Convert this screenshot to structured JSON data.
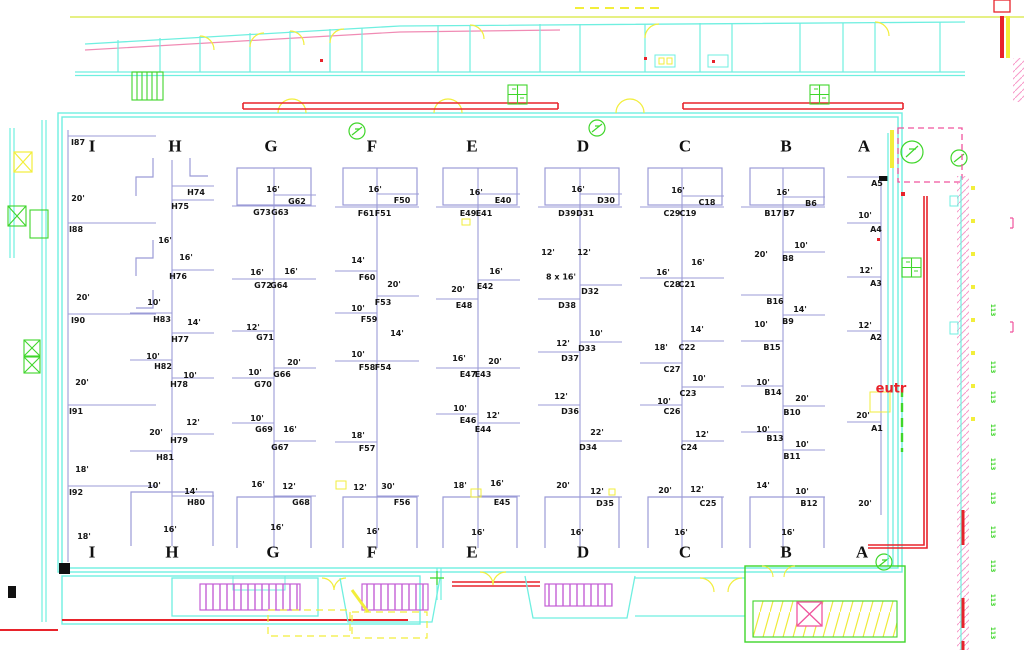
{
  "title": "Exhibit hall booth layout floor plan",
  "colors": {
    "wall_cyan": "#6fefe0",
    "booth_line": "#9b9bd7",
    "accent_red": "#e8232b",
    "yellow": "#f2ee3b",
    "green": "#3fd62a",
    "purple_hatch": "#c45fd6",
    "pink_hatch": "#f799c9",
    "magenta_dash": "#f0559e",
    "pink_line": "#f08bb4",
    "text": "#151515"
  },
  "letters": {
    "y_top": 146,
    "y_bottom": 552,
    "top": [
      {
        "t": "I",
        "x": 92
      },
      {
        "t": "H",
        "x": 175
      },
      {
        "t": "G",
        "x": 271
      },
      {
        "t": "F",
        "x": 372
      },
      {
        "t": "E",
        "x": 472
      },
      {
        "t": "D",
        "x": 583
      },
      {
        "t": "C",
        "x": 685
      },
      {
        "t": "B",
        "x": 786
      },
      {
        "t": "A",
        "x": 864
      }
    ],
    "bottom": [
      {
        "t": "I",
        "x": 92
      },
      {
        "t": "H",
        "x": 172
      },
      {
        "t": "G",
        "x": 273
      },
      {
        "t": "F",
        "x": 372
      },
      {
        "t": "E",
        "x": 472
      },
      {
        "t": "D",
        "x": 583
      },
      {
        "t": "C",
        "x": 685
      },
      {
        "t": "B",
        "x": 786
      },
      {
        "t": "A",
        "x": 862
      }
    ]
  },
  "spines": {
    "I": {
      "x": 68,
      "y1": 130,
      "y2": 562,
      "tlen": 88
    },
    "H": {
      "x": 172,
      "y1": 160,
      "y2": 546,
      "tlen": 42
    },
    "G": {
      "x": 274,
      "y1": 168,
      "y2": 548,
      "tlen": 42
    },
    "F": {
      "x": 377,
      "y1": 168,
      "y2": 548,
      "tlen": 42
    },
    "E": {
      "x": 478,
      "y1": 168,
      "y2": 548,
      "tlen": 42
    },
    "D": {
      "x": 580,
      "y1": 168,
      "y2": 548,
      "tlen": 42
    },
    "C": {
      "x": 682,
      "y1": 168,
      "y2": 548,
      "tlen": 42
    },
    "B": {
      "x": 783,
      "y1": 168,
      "y2": 548,
      "tlen": 42
    },
    "A": {
      "x": 881,
      "y1": 178,
      "y2": 515,
      "tlen": 34
    }
  },
  "booths": [
    [
      "I87",
      78,
      143
    ],
    [
      "I88",
      76,
      230
    ],
    [
      "I90",
      78,
      321
    ],
    [
      "I91",
      76,
      412
    ],
    [
      "I92",
      76,
      493
    ],
    [
      "H74",
      196,
      193
    ],
    [
      "H75",
      180,
      207
    ],
    [
      "H76",
      178,
      277
    ],
    [
      "H83",
      162,
      320
    ],
    [
      "H77",
      180,
      340
    ],
    [
      "H82",
      163,
      367
    ],
    [
      "H78",
      179,
      385
    ],
    [
      "H79",
      179,
      441
    ],
    [
      "H81",
      165,
      458
    ],
    [
      "H80",
      196,
      503
    ],
    [
      "G62",
      297,
      202
    ],
    [
      "G73",
      262,
      213
    ],
    [
      "G63",
      280,
      213
    ],
    [
      "G72",
      263,
      286
    ],
    [
      "G64",
      279,
      286
    ],
    [
      "G71",
      265,
      338
    ],
    [
      "G66",
      282,
      375
    ],
    [
      "G70",
      263,
      385
    ],
    [
      "G69",
      264,
      430
    ],
    [
      "G67",
      280,
      448
    ],
    [
      "G68",
      301,
      503
    ],
    [
      "F50",
      402,
      201
    ],
    [
      "F61",
      366,
      214
    ],
    [
      "F51",
      383,
      214
    ],
    [
      "F60",
      367,
      278
    ],
    [
      "F53",
      383,
      303
    ],
    [
      "F59",
      369,
      320
    ],
    [
      "F58",
      367,
      368
    ],
    [
      "F54",
      383,
      368
    ],
    [
      "F57",
      367,
      449
    ],
    [
      "F56",
      402,
      503
    ],
    [
      "E40",
      503,
      201
    ],
    [
      "E49",
      468,
      214
    ],
    [
      "E41",
      484,
      214
    ],
    [
      "E42",
      485,
      287
    ],
    [
      "E48",
      464,
      306
    ],
    [
      "E47",
      468,
      375
    ],
    [
      "E43",
      483,
      375
    ],
    [
      "E46",
      468,
      421
    ],
    [
      "E44",
      483,
      430
    ],
    [
      "E45",
      502,
      503
    ],
    [
      "D30",
      606,
      201
    ],
    [
      "D39",
      567,
      214
    ],
    [
      "D31",
      585,
      214
    ],
    [
      "D32",
      590,
      292
    ],
    [
      "D38",
      567,
      306
    ],
    [
      "D33",
      587,
      349
    ],
    [
      "D37",
      570,
      359
    ],
    [
      "D36",
      570,
      412
    ],
    [
      "D34",
      588,
      448
    ],
    [
      "D35",
      605,
      504
    ],
    [
      "C18",
      707,
      203
    ],
    [
      "C29",
      672,
      214
    ],
    [
      "C19",
      688,
      214
    ],
    [
      "C28",
      672,
      285
    ],
    [
      "C21",
      687,
      285
    ],
    [
      "C22",
      687,
      348
    ],
    [
      "C27",
      672,
      370
    ],
    [
      "C23",
      688,
      394
    ],
    [
      "C26",
      672,
      412
    ],
    [
      "C24",
      689,
      448
    ],
    [
      "C25",
      708,
      504
    ],
    [
      "B6",
      811,
      204
    ],
    [
      "B17",
      773,
      214
    ],
    [
      "B7",
      789,
      214
    ],
    [
      "B8",
      788,
      259
    ],
    [
      "B16",
      775,
      302
    ],
    [
      "B9",
      788,
      322
    ],
    [
      "B15",
      772,
      348
    ],
    [
      "B14",
      773,
      393
    ],
    [
      "B10",
      792,
      413
    ],
    [
      "B13",
      775,
      439
    ],
    [
      "B11",
      792,
      457
    ],
    [
      "B12",
      809,
      504
    ],
    [
      "A5",
      877,
      184
    ],
    [
      "A4",
      876,
      230
    ],
    [
      "A3",
      876,
      284
    ],
    [
      "A2",
      876,
      338
    ],
    [
      "A1",
      877,
      429
    ]
  ],
  "dims": [
    [
      "20'",
      78,
      199
    ],
    [
      "20'",
      83,
      298
    ],
    [
      "20'",
      82,
      383
    ],
    [
      "18'",
      82,
      470
    ],
    [
      "18'",
      84,
      537
    ],
    [
      "16'",
      165,
      241
    ],
    [
      "16'",
      186,
      258
    ],
    [
      "10'",
      154,
      303
    ],
    [
      "14'",
      194,
      323
    ],
    [
      "10'",
      153,
      357
    ],
    [
      "10'",
      190,
      376
    ],
    [
      "12'",
      193,
      423
    ],
    [
      "20'",
      156,
      433
    ],
    [
      "10'",
      154,
      486
    ],
    [
      "14'",
      191,
      492
    ],
    [
      "16'",
      170,
      530
    ],
    [
      "16'",
      273,
      190
    ],
    [
      "16'",
      257,
      273
    ],
    [
      "16'",
      291,
      272
    ],
    [
      "12'",
      253,
      328
    ],
    [
      "20'",
      294,
      363
    ],
    [
      "10'",
      255,
      373
    ],
    [
      "10'",
      257,
      419
    ],
    [
      "16'",
      290,
      430
    ],
    [
      "16'",
      258,
      485
    ],
    [
      "12'",
      289,
      487
    ],
    [
      "16'",
      277,
      528
    ],
    [
      "16'",
      375,
      190
    ],
    [
      "14'",
      358,
      261
    ],
    [
      "20'",
      394,
      285
    ],
    [
      "10'",
      358,
      309
    ],
    [
      "14'",
      397,
      334
    ],
    [
      "10'",
      358,
      355
    ],
    [
      "18'",
      358,
      436
    ],
    [
      "12'",
      360,
      488
    ],
    [
      "30'",
      388,
      487
    ],
    [
      "16'",
      373,
      532
    ],
    [
      "16'",
      476,
      193
    ],
    [
      "16'",
      496,
      272
    ],
    [
      "20'",
      458,
      290
    ],
    [
      "16'",
      459,
      359
    ],
    [
      "20'",
      495,
      362
    ],
    [
      "10'",
      460,
      409
    ],
    [
      "12'",
      493,
      416
    ],
    [
      "18'",
      460,
      486
    ],
    [
      "16'",
      497,
      484
    ],
    [
      "16'",
      478,
      533
    ],
    [
      "16'",
      578,
      190
    ],
    [
      "12'",
      548,
      253
    ],
    [
      "12'",
      584,
      253
    ],
    [
      "10'",
      596,
      334
    ],
    [
      "12'",
      563,
      344
    ],
    [
      "12'",
      561,
      397
    ],
    [
      "22'",
      597,
      433
    ],
    [
      "20'",
      563,
      486
    ],
    [
      "12'",
      597,
      492
    ],
    [
      "16'",
      577,
      533
    ],
    [
      "16'",
      678,
      191
    ],
    [
      "16'",
      698,
      263
    ],
    [
      "16'",
      663,
      273
    ],
    [
      "14'",
      697,
      330
    ],
    [
      "18'",
      661,
      348
    ],
    [
      "10'",
      699,
      379
    ],
    [
      "10'",
      664,
      402
    ],
    [
      "12'",
      702,
      435
    ],
    [
      "20'",
      665,
      491
    ],
    [
      "12'",
      697,
      490
    ],
    [
      "16'",
      681,
      533
    ],
    [
      "16'",
      783,
      193
    ],
    [
      "10'",
      801,
      246
    ],
    [
      "20'",
      761,
      255
    ],
    [
      "14'",
      800,
      310
    ],
    [
      "10'",
      761,
      325
    ],
    [
      "10'",
      763,
      383
    ],
    [
      "20'",
      802,
      399
    ],
    [
      "10'",
      763,
      430
    ],
    [
      "10'",
      802,
      445
    ],
    [
      "14'",
      763,
      486
    ],
    [
      "10'",
      802,
      492
    ],
    [
      "16'",
      788,
      533
    ],
    [
      "10'",
      865,
      216
    ],
    [
      "12'",
      866,
      271
    ],
    [
      "12'",
      865,
      326
    ],
    [
      "20'",
      863,
      416
    ],
    [
      "20'",
      865,
      504
    ]
  ],
  "note_8x16": {
    "t": "8 x 16'",
    "x": 561,
    "y": 277
  },
  "entry_label": {
    "t": "eutr",
    "x": 891,
    "y": 389
  },
  "side_tags": [
    {
      "t": "113",
      "x": 992,
      "y": 310,
      "m": false
    },
    {
      "t": "113",
      "x": 992,
      "y": 367,
      "m": false
    },
    {
      "t": "113",
      "x": 992,
      "y": 397,
      "m": false
    },
    {
      "t": "113",
      "x": 992,
      "y": 430,
      "m": false
    },
    {
      "t": "113",
      "x": 992,
      "y": 464,
      "m": false
    },
    {
      "t": "113",
      "x": 992,
      "y": 498,
      "m": false
    },
    {
      "t": "113",
      "x": 992,
      "y": 532,
      "m": false
    },
    {
      "t": "113",
      "x": 992,
      "y": 566,
      "m": false
    },
    {
      "t": "113",
      "x": 992,
      "y": 600,
      "m": false
    },
    {
      "t": "113",
      "x": 992,
      "y": 633,
      "m": false
    }
  ]
}
